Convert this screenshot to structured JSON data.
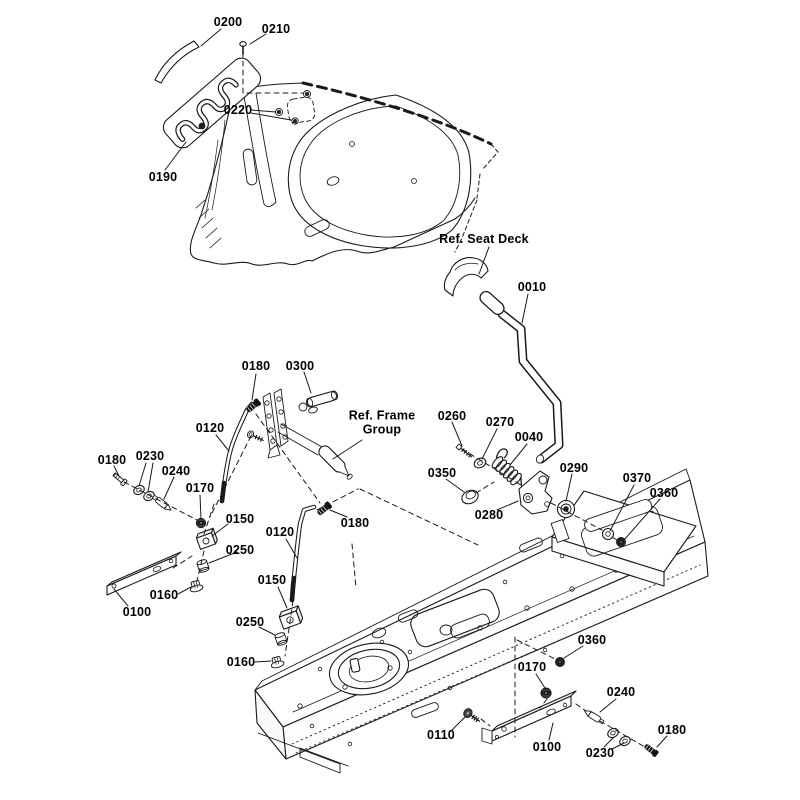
{
  "diagram_type": "exploded-parts-diagram",
  "colors": {
    "background": "#ffffff",
    "line": "#1a1a1a",
    "label_text": "#000000"
  },
  "reference_labels": [
    {
      "text": "Ref. Seat Deck"
    },
    {
      "line1": "Ref. Frame",
      "line2": "Group"
    }
  ],
  "part_labels": [
    {
      "part": "0200"
    },
    {
      "part": "0210"
    },
    {
      "part": "0220"
    },
    {
      "part": "0190"
    },
    {
      "part": "0010"
    },
    {
      "part": "0180"
    },
    {
      "part": "0300"
    },
    {
      "part": "0120"
    },
    {
      "part": "0260"
    },
    {
      "part": "0270"
    },
    {
      "part": "0040"
    },
    {
      "part": "0180"
    },
    {
      "part": "0230"
    },
    {
      "part": "0240"
    },
    {
      "part": "0170"
    },
    {
      "part": "0350"
    },
    {
      "part": "0290"
    },
    {
      "part": "0370"
    },
    {
      "part": "0360"
    },
    {
      "part": "0150"
    },
    {
      "part": "0280"
    },
    {
      "part": "0120"
    },
    {
      "part": "0180"
    },
    {
      "part": "0250"
    },
    {
      "part": "0160"
    },
    {
      "part": "0100"
    },
    {
      "part": "0150"
    },
    {
      "part": "0250"
    },
    {
      "part": "0160"
    },
    {
      "part": "0360"
    },
    {
      "part": "0170"
    },
    {
      "part": "0110"
    },
    {
      "part": "0100"
    },
    {
      "part": "0240"
    },
    {
      "part": "0230"
    },
    {
      "part": "0180"
    }
  ],
  "unique_parts": [
    "0010",
    "0040",
    "0100",
    "0110",
    "0120",
    "0150",
    "0160",
    "0170",
    "0180",
    "0190",
    "0200",
    "0210",
    "0220",
    "0230",
    "0240",
    "0250",
    "0260",
    "0270",
    "0280",
    "0290",
    "0300",
    "0350",
    "0360",
    "0370"
  ]
}
